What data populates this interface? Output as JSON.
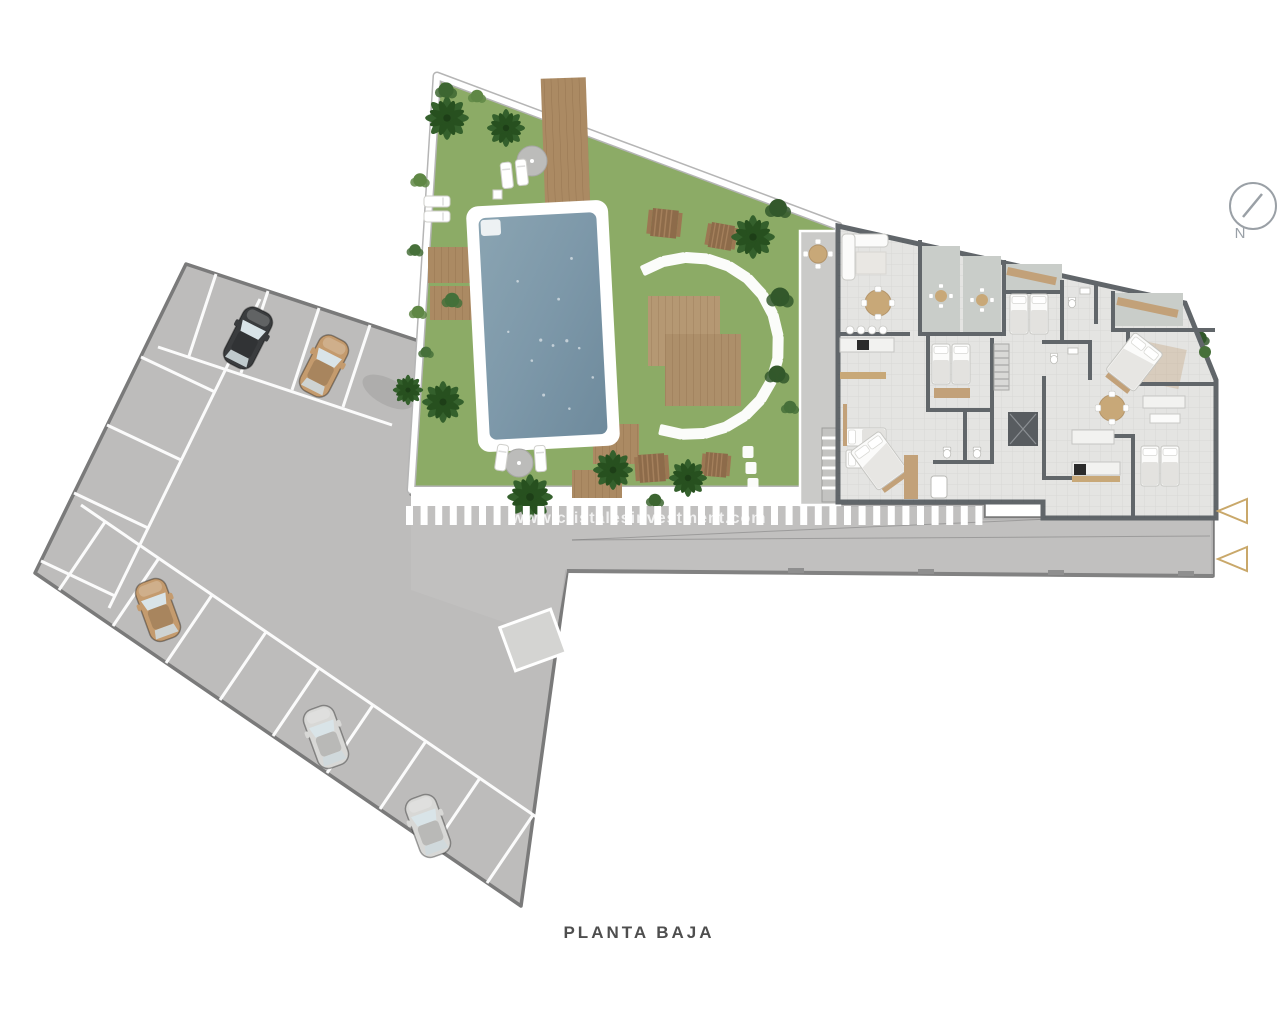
{
  "meta": {
    "document_type": "architectural site plan",
    "floor_label": "PLANTA BAJA"
  },
  "compass": {
    "label": "N"
  },
  "watermark": {
    "text": "www.cristalesinvestment.com"
  },
  "areas": {
    "parking_lot": {
      "name": "parking lot",
      "fill": "#bdbcbb",
      "outline": "#7a7a7a"
    },
    "road": {
      "name": "access road",
      "fill": "#c2c1c0"
    },
    "garden": {
      "name": "communal garden",
      "fill": "#8cab66"
    },
    "pool": {
      "name": "swimming pool",
      "water": "#7d98a9",
      "coping": "#ffffff"
    },
    "building": {
      "name": "apartment building ground floor",
      "floor": "#e4e4e2",
      "walls": "#61666a",
      "terrace": "#c9cdc9"
    },
    "crosswalk": {
      "name": "pedestrian crossing",
      "color": "#ffffff"
    }
  },
  "render": {
    "crosswalk": {
      "x0": 406,
      "y": 506,
      "w": 7,
      "h": 19,
      "gap": 14.6,
      "count": 40
    },
    "stones": {
      "cx": 690,
      "cy": 346,
      "r": 88,
      "start": -115,
      "end": 116,
      "step": 14.5,
      "w": 24,
      "h": 11,
      "extra": [
        [
          748,
          452
        ],
        [
          751,
          468
        ],
        [
          753,
          484
        ]
      ]
    },
    "cars": [
      {
        "x": 248,
        "y": 338,
        "rot": 27,
        "color": "#3a3c3e",
        "desc": "black car"
      },
      {
        "x": 324,
        "y": 366,
        "rot": 27,
        "color": "#c49b6e",
        "desc": "tan car"
      },
      {
        "x": 158,
        "y": 610,
        "rot": -20,
        "color": "#c49b6e",
        "desc": "tan car"
      },
      {
        "x": 326,
        "y": 737,
        "rot": -20,
        "color": "#d8d8d6",
        "desc": "silver car"
      },
      {
        "x": 428,
        "y": 826,
        "rot": -20,
        "color": "#d8d8d6",
        "desc": "silver car"
      }
    ],
    "palms": [
      {
        "x": 447,
        "y": 118,
        "s": 1.15
      },
      {
        "x": 506,
        "y": 128,
        "s": 1.0
      },
      {
        "x": 443,
        "y": 402,
        "s": 1.1
      },
      {
        "x": 408,
        "y": 390,
        "s": 0.8
      },
      {
        "x": 530,
        "y": 497,
        "s": 1.2
      },
      {
        "x": 613,
        "y": 470,
        "s": 1.05
      },
      {
        "x": 688,
        "y": 478,
        "s": 1.0
      },
      {
        "x": 753,
        "y": 237,
        "s": 1.15
      }
    ],
    "bushes": [
      {
        "x": 778,
        "y": 208,
        "s": 1.0,
        "c": "#33582b"
      },
      {
        "x": 780,
        "y": 297,
        "s": 1.05,
        "c": "#33582b"
      },
      {
        "x": 777,
        "y": 374,
        "s": 0.95,
        "c": "#33582b"
      },
      {
        "x": 790,
        "y": 407,
        "s": 0.7,
        "c": "#47703a"
      },
      {
        "x": 420,
        "y": 180,
        "s": 0.75,
        "c": "#5f8745"
      },
      {
        "x": 415,
        "y": 250,
        "s": 0.65,
        "c": "#47703a"
      },
      {
        "x": 418,
        "y": 312,
        "s": 0.7,
        "c": "#5f8745"
      },
      {
        "x": 426,
        "y": 352,
        "s": 0.6,
        "c": "#47703a"
      },
      {
        "x": 446,
        "y": 90,
        "s": 0.85,
        "c": "#3d6631"
      },
      {
        "x": 477,
        "y": 96,
        "s": 0.7,
        "c": "#5f8745"
      },
      {
        "x": 452,
        "y": 300,
        "s": 0.8,
        "c": "#44703a"
      },
      {
        "x": 927,
        "y": 249,
        "s": 0.55,
        "c": "#3d6631"
      },
      {
        "x": 966,
        "y": 262,
        "s": 0.55,
        "c": "#3d6631"
      },
      {
        "x": 975,
        "y": 328,
        "s": 0.5,
        "c": "#3d6631"
      },
      {
        "x": 1200,
        "y": 338,
        "s": 0.75,
        "c": "#33582b"
      },
      {
        "x": 655,
        "y": 500,
        "s": 0.7,
        "c": "#3d6631"
      }
    ]
  }
}
